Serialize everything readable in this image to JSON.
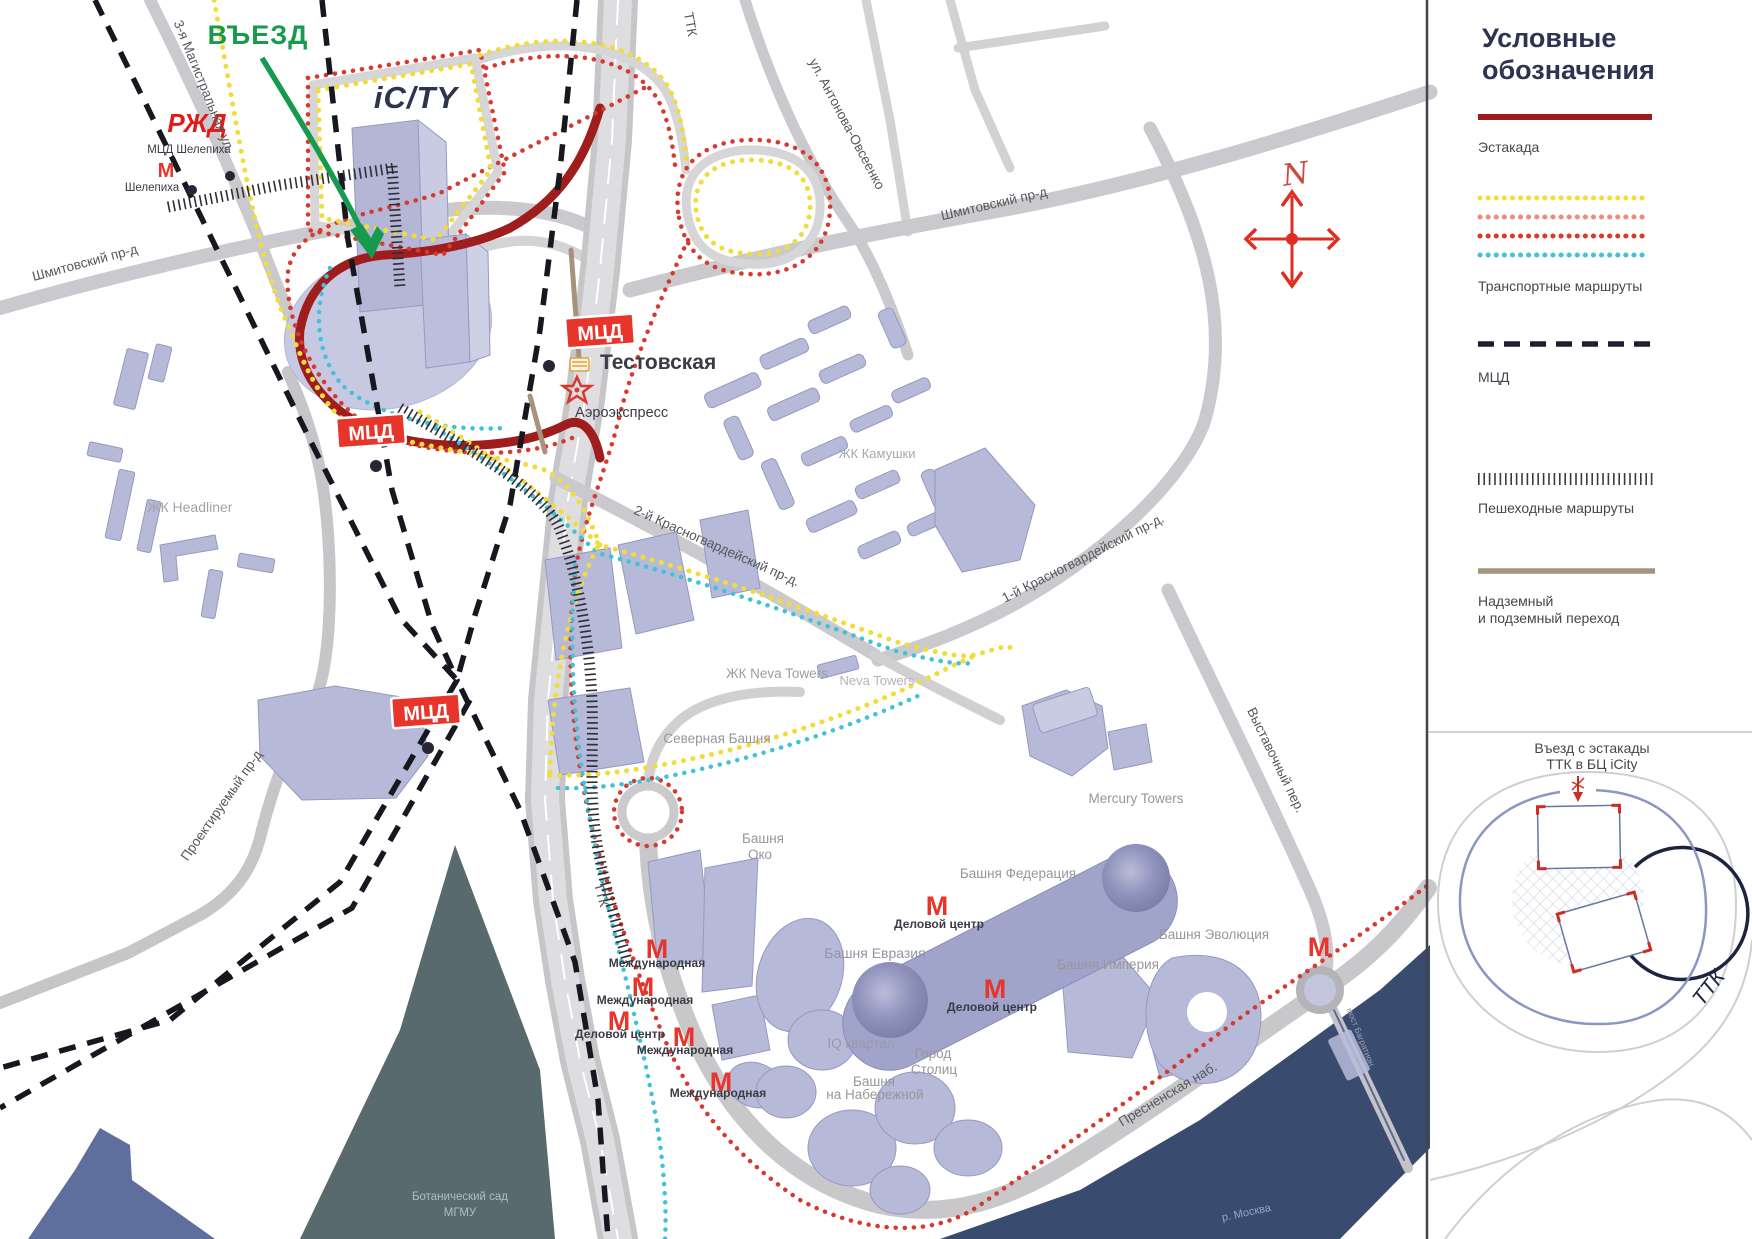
{
  "map": {
    "entrance": "ВЪЕЗД",
    "icity_logo": "iC/TY",
    "rzd": "РЖД",
    "metro_m": "М",
    "mcd_badge": "МЦД",
    "compass_n": "N",
    "stations": {
      "mcd_shelepikha": "МЦД Шелепиха",
      "shelepikha": "Шелепиха",
      "testovskaya": "Тестовская",
      "aeroexpress": "Аэроэкспресс",
      "mezhdunarodnaya": "Международная",
      "delovoy_centr": "Деловой центр"
    },
    "streets": {
      "ttk": "ТТК",
      "magistralnaya": "3-я Магистральная ул.",
      "shmitovsky": "Шмитовский пр-д",
      "antonova": "ул. Антонова-Овсеенко",
      "krasnogv2": "2-й Красногвардейский пр-д.",
      "krasnogv1": "1-й Красногвардейский пр-д.",
      "vystavochny": "Выставочный пер.",
      "proektiruemy": "Проектируемый пр-д",
      "presnenskaya": "Пресненская наб.",
      "bagration": "мост Багратион",
      "river": "р. Москва"
    },
    "places": {
      "headliner": "ЖК Headliner",
      "kamushki": "ЖК Камушки",
      "neva": "ЖК Neva Towers",
      "neva2": "Neva Towers",
      "severnaya": "Северная Башня",
      "oko1": "Башня",
      "oko2": "Око",
      "evraziya": "Башня Евразия",
      "federation": "Башня Федерация",
      "mercury": "Mercury Towers",
      "evolution": "Башня Эволюция",
      "imperia": "Башня Империя",
      "iq": "IQ квартал",
      "gorod1": "Город",
      "gorod2": "Столиц",
      "nab1": "Башня",
      "nab2": "на Набережной",
      "botsad1": "Ботанический сад",
      "botsad2": "МГМУ"
    }
  },
  "legend": {
    "title1": "Условные",
    "title2": "обозначения",
    "estakada": "Эстакада",
    "transport": "Транспортные маршруты",
    "mcd": "МЦД",
    "pedestrian": "Пешеходные маршруты",
    "crossing1": "Надземный",
    "crossing2": "и подземный переход",
    "colors": {
      "estakada": "#9e1b1d",
      "route_yellow": "#f0dd3c",
      "route_salmon": "#ee8a7c",
      "route_red": "#d8392f",
      "route_cyan": "#41c2d9",
      "mcd_line": "#1e2030",
      "crossing_line": "#a6937d",
      "metro_red": "#e8342b",
      "entrance_green": "#169a4e"
    }
  },
  "inset": {
    "title1": "Въезд с эстакады",
    "title2": "ТТК в БЦ iCity",
    "ttk": "ТТК"
  }
}
